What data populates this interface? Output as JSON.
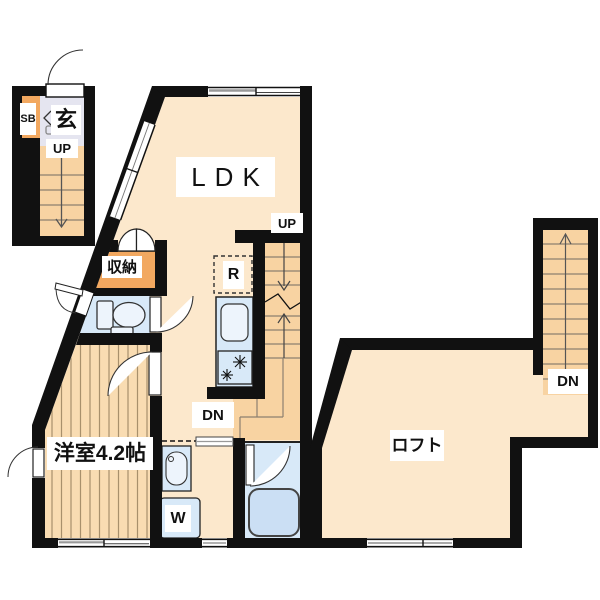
{
  "document": {
    "type": "apartment-floor-plan"
  },
  "palette": {
    "wall": "#111111",
    "floor_peach": "#FCE8CC",
    "stairs_orange": "#F8D3A2",
    "wood_floor": "#F9DCB2",
    "wood_line": "#A8906C",
    "storage_orange": "#F2A860",
    "water_blue": "#D8E9F8",
    "fixture_light": "#EDF4FC",
    "bathtub_blue": "#CBDFF4",
    "entrance_gray": "#E5E5F0",
    "step_line": "#8D8070"
  },
  "labels": {
    "entrance": "玄",
    "shoe_box": "SB",
    "up_entrance": "UP",
    "ldk": "LDK",
    "up_main": "UP",
    "storage": "収納",
    "refrigerator": "R",
    "dn_main": "DN",
    "western_room": "洋室4.2帖",
    "washer": "W",
    "loft": "ロフト",
    "dn_loft": "DN"
  },
  "fixtures": [
    "toilet",
    "kitchen-sink",
    "gas-stove",
    "refrigerator-space",
    "washbasin",
    "washing-machine-space",
    "bathtub",
    "staircase-entrance",
    "staircase-main",
    "staircase-loft",
    "double-closet-doors",
    "sliding-window",
    "hinged-doors"
  ]
}
